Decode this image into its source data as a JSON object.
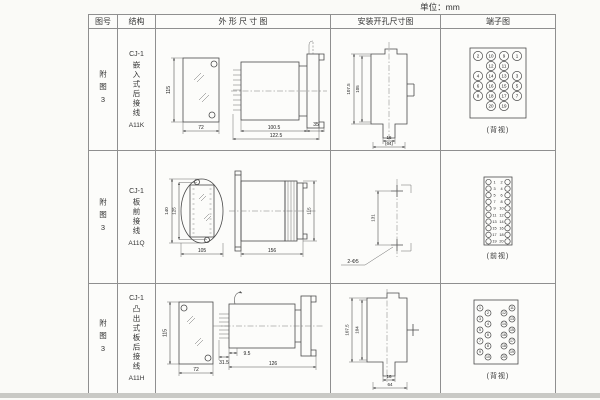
{
  "unit_label": "单位：mm",
  "header": {
    "col_fig": "图号",
    "col_struct": "结构",
    "col_outline": "外 形 尺 寸 图",
    "col_mount": "安装开孔尺寸图",
    "col_terminal": "端子图"
  },
  "rows": [
    {
      "fig_no": "附图3",
      "model": "CJ-1",
      "structure_name": "嵌入式后接线",
      "code": "A11K",
      "outline": {
        "front_height": "115",
        "front_width": "72",
        "depth_inner": "100.5",
        "depth_total": "122.5",
        "flange": "35"
      },
      "mount": {
        "height_outer": "107.5",
        "height_inner": "105",
        "slot_width": "16",
        "slot_span": "(64)"
      },
      "terminal_view": "(背视)"
    },
    {
      "fig_no": "附图3",
      "model": "CJ-1",
      "structure_name": "板前接线",
      "code": "A11Q",
      "outline": {
        "height_outer": "140",
        "height_inner": "125",
        "width": "105",
        "depth": "156",
        "side_height": "115"
      },
      "mount": {
        "hole_pitch": "131",
        "hole_label": "2-Φ5"
      },
      "terminal_view": "(前视)"
    },
    {
      "fig_no": "附图3",
      "model": "CJ-1",
      "structure_name": "凸出式板后接线",
      "code": "A11H",
      "outline": {
        "front_height": "115",
        "front_width": "72",
        "pin_depth": "31.5",
        "gap": "9.5",
        "depth": "126"
      },
      "mount": {
        "height_outer": "107.5",
        "height_inner": "104",
        "slot_width": "16",
        "slot_span": "64"
      },
      "terminal_view": "(背视)"
    }
  ],
  "terminals": {
    "back20": [
      {
        "c": 0,
        "r": 0,
        "n": "2"
      },
      {
        "c": 1,
        "r": 0,
        "n": "10"
      },
      {
        "c": 2,
        "r": 0,
        "n": "9"
      },
      {
        "c": 3,
        "r": 0,
        "n": "1"
      },
      {
        "c": 1,
        "r": 1,
        "n": "12"
      },
      {
        "c": 2,
        "r": 1,
        "n": "11"
      },
      {
        "c": 0,
        "r": 2,
        "n": "4"
      },
      {
        "c": 1,
        "r": 2,
        "n": "14"
      },
      {
        "c": 2,
        "r": 2,
        "n": "13"
      },
      {
        "c": 3,
        "r": 2,
        "n": "3"
      },
      {
        "c": 0,
        "r": 3,
        "n": "6"
      },
      {
        "c": 1,
        "r": 3,
        "n": "16"
      },
      {
        "c": 2,
        "r": 3,
        "n": "15"
      },
      {
        "c": 3,
        "r": 3,
        "n": "5"
      },
      {
        "c": 0,
        "r": 4,
        "n": "8"
      },
      {
        "c": 1,
        "r": 4,
        "n": "18"
      },
      {
        "c": 2,
        "r": 4,
        "n": "17"
      },
      {
        "c": 3,
        "r": 4,
        "n": "7"
      },
      {
        "c": 1,
        "r": 5,
        "n": "20"
      },
      {
        "c": 2,
        "r": 5,
        "n": "19"
      }
    ],
    "front_pairs": [
      [
        "1",
        "2"
      ],
      [
        "3",
        "4"
      ],
      [
        "5",
        "6"
      ],
      [
        "7",
        "8"
      ],
      [
        "9",
        "10"
      ],
      [
        "11",
        "12"
      ],
      [
        "13",
        "14"
      ],
      [
        "15",
        "16"
      ],
      [
        "17",
        "18"
      ],
      [
        "19",
        "20"
      ]
    ],
    "back_stagger": [
      {
        "x": 11,
        "y": 12,
        "n": "1"
      },
      {
        "x": 11,
        "y": 23,
        "n": "3"
      },
      {
        "x": 11,
        "y": 34,
        "n": "5"
      },
      {
        "x": 11,
        "y": 45,
        "n": "7"
      },
      {
        "x": 11,
        "y": 56,
        "n": "9"
      },
      {
        "x": 19,
        "y": 17,
        "n": "2"
      },
      {
        "x": 19,
        "y": 28,
        "n": "4"
      },
      {
        "x": 19,
        "y": 39,
        "n": "6"
      },
      {
        "x": 19,
        "y": 50,
        "n": "8"
      },
      {
        "x": 19,
        "y": 61,
        "n": "10"
      },
      {
        "x": 35,
        "y": 17,
        "n": "12"
      },
      {
        "x": 35,
        "y": 28,
        "n": "14"
      },
      {
        "x": 35,
        "y": 39,
        "n": "16"
      },
      {
        "x": 35,
        "y": 50,
        "n": "18"
      },
      {
        "x": 35,
        "y": 61,
        "n": "20"
      },
      {
        "x": 43,
        "y": 12,
        "n": "11"
      },
      {
        "x": 43,
        "y": 23,
        "n": "13"
      },
      {
        "x": 43,
        "y": 34,
        "n": "15"
      },
      {
        "x": 43,
        "y": 45,
        "n": "17"
      },
      {
        "x": 43,
        "y": 56,
        "n": "19"
      }
    ]
  }
}
